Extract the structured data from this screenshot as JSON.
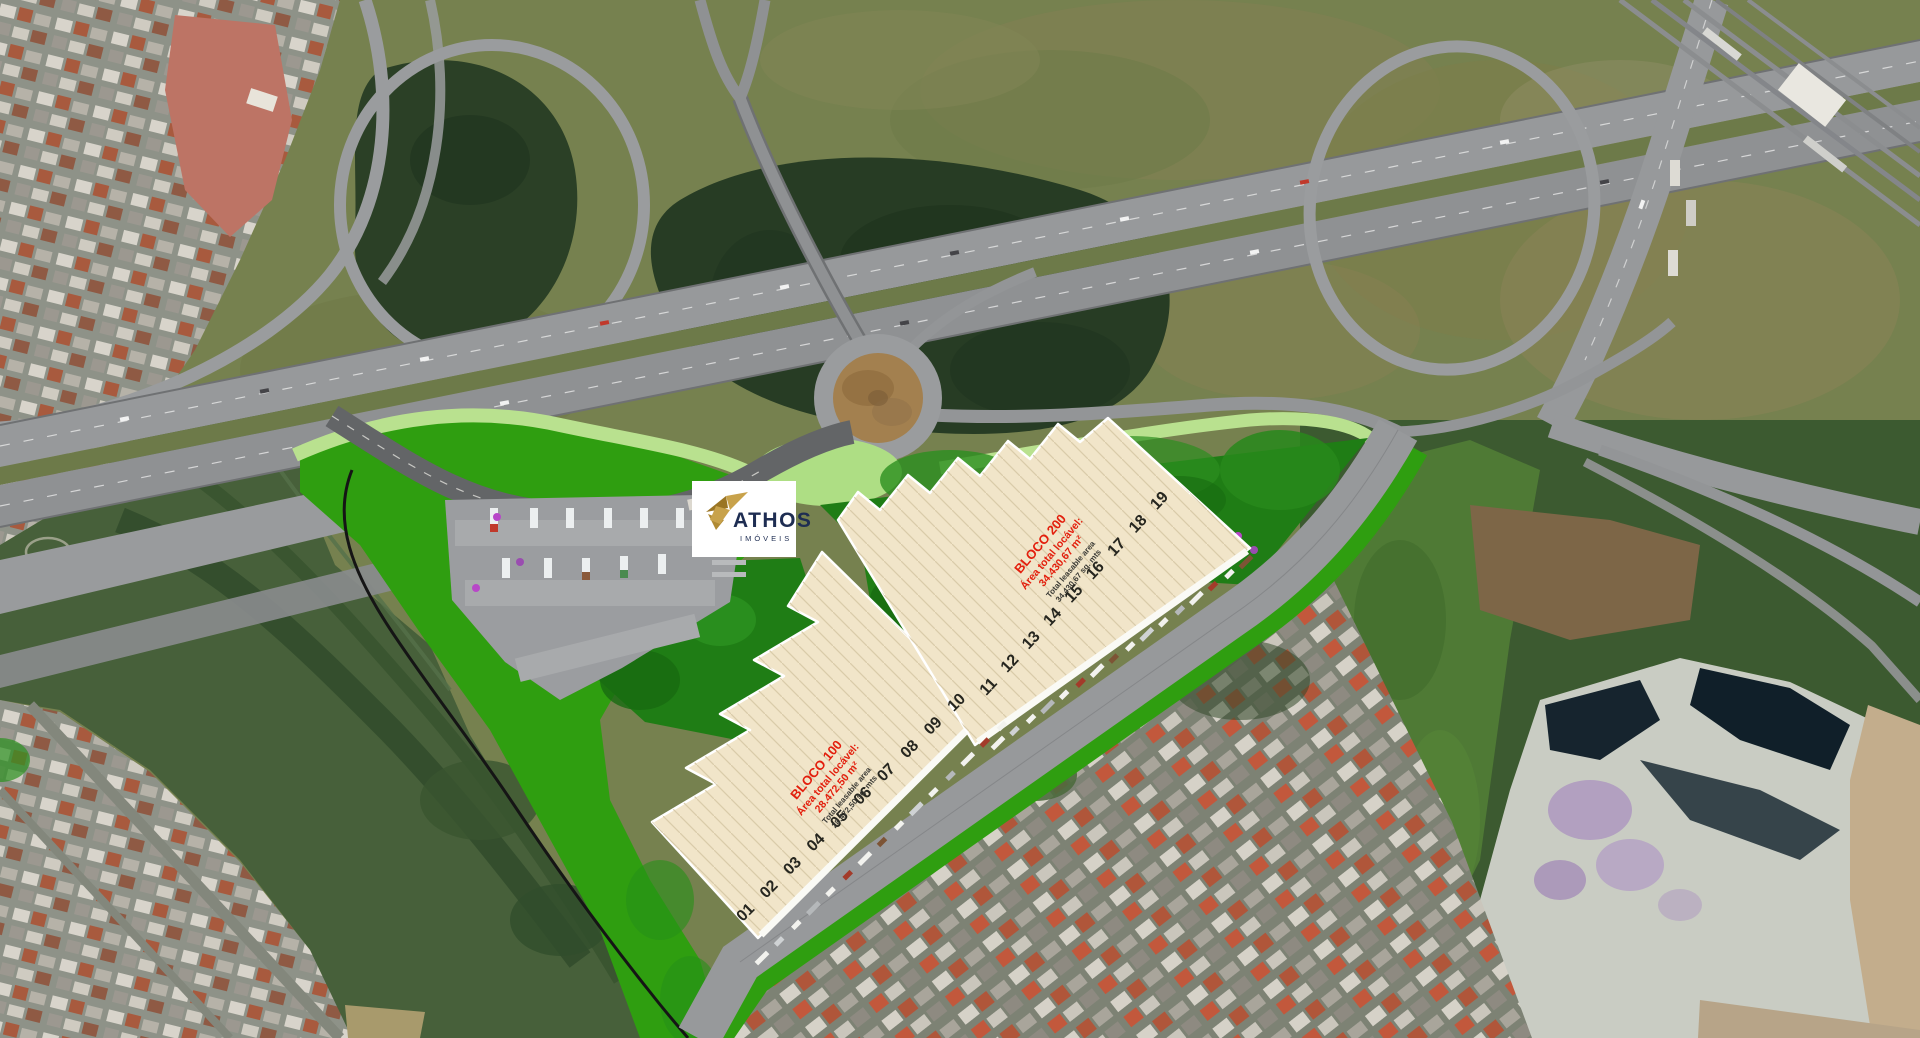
{
  "map": {
    "type": "aerial-masterplan-render",
    "road_label": "VIA DE ACESSO"
  },
  "logo": {
    "name": "ATHOS",
    "subtitle": "IMÓVEIS"
  },
  "buildings": [
    {
      "id": "bloco-100",
      "title": "BLOCO 100",
      "area_label": "Área total locável:",
      "area_value": "28.472,50 m²",
      "leasable_label": "Total leasable area",
      "leasable_value": "28.472,50 sq. mts",
      "docks": [
        "01",
        "02",
        "03",
        "04",
        "05",
        "06",
        "07",
        "08",
        "09",
        "10"
      ]
    },
    {
      "id": "bloco-200",
      "title": "BLOCO 200",
      "area_label": "Área total locável:",
      "area_value": "34.430,67 m²",
      "leasable_label": "Total leasable area",
      "leasable_value": "34.430,67 sq. mts",
      "docks": [
        "11",
        "12",
        "13",
        "14",
        "15",
        "16",
        "17",
        "18",
        "19"
      ]
    }
  ],
  "colors": {
    "accent_red": "#E31E0C",
    "logo_navy": "#1E2D52",
    "logo_gold": "#C8A24B",
    "lawn_green": "#2F9E10",
    "building_cream": "#F1E5C9",
    "highway_gray": "#97999B"
  }
}
